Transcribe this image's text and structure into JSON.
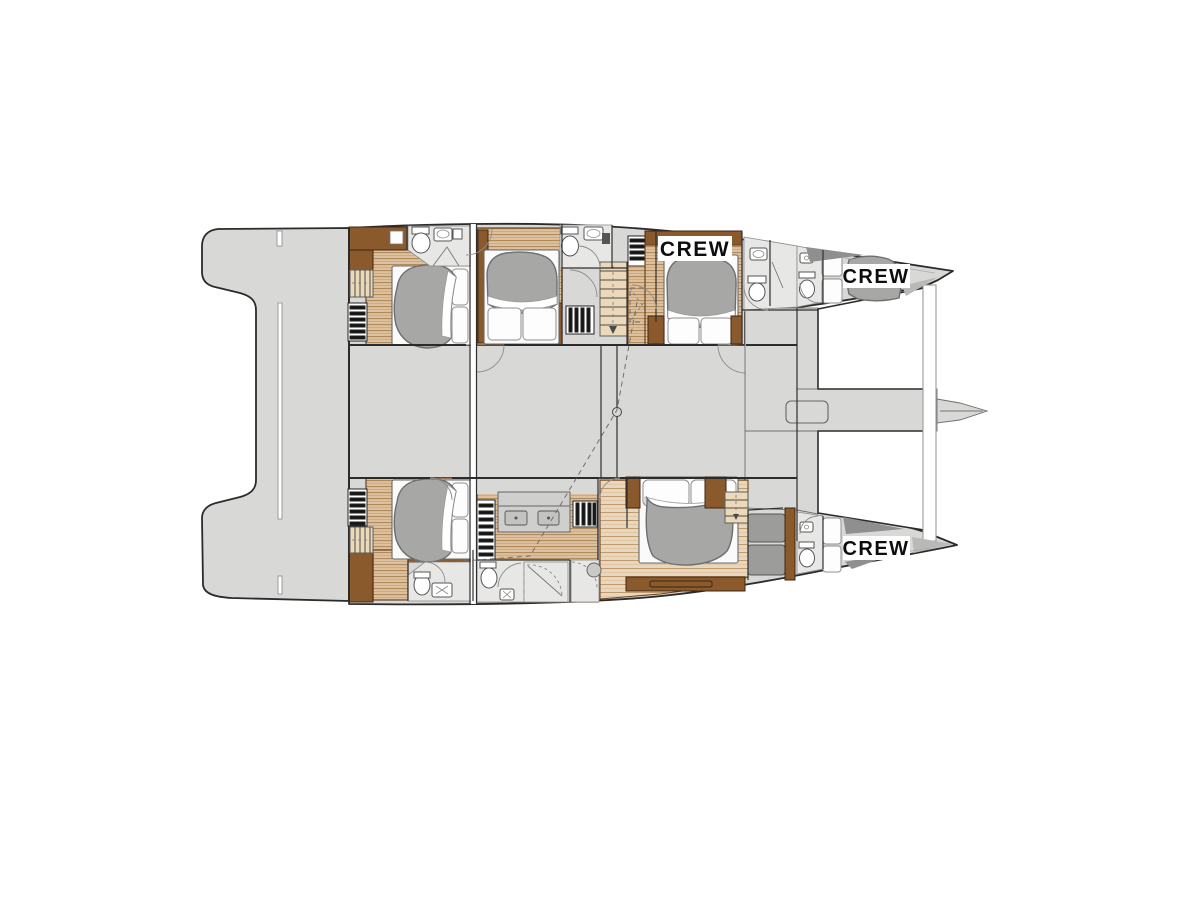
{
  "labels": {
    "crew": [
      "CREW",
      "CREW",
      "CREW"
    ]
  },
  "palette": {
    "background": "#ffffff",
    "deck": "#d8d8d6",
    "deck_light": "#e7e7e5",
    "outline": "#2b2b2b",
    "wood_light": "#ddc09e",
    "wood_stripe": "#b08a5a",
    "plank_light": "#e8d7bd",
    "cabinet_brown": "#8a5a2c",
    "trim_brown": "#6b4423",
    "stairs_tan": "#ecd9ba",
    "duvet_gray": "#a7a7a5",
    "duvet_outline": "#6e6e6e",
    "fixture_white": "#ffffff",
    "vent_black": "#161616",
    "shadow_dark": "#8f8f8f",
    "shadow_light": "#b9b9b7",
    "label_bg": "#ffffff",
    "label_text": "#0d0d0d"
  }
}
